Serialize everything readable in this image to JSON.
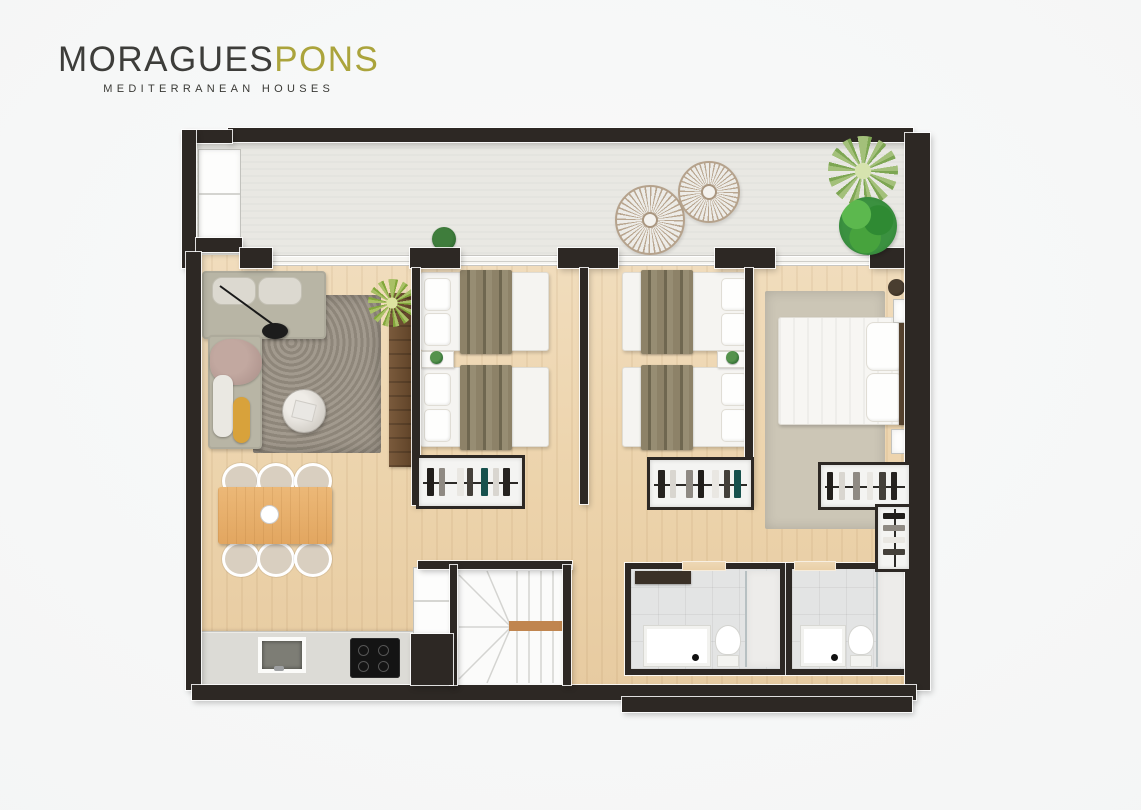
{
  "brand": {
    "wordmark_primary": "MORAGUES",
    "wordmark_accent": "PONS",
    "tagline": "MEDITERRANEAN HOUSES"
  },
  "palette": {
    "accent": "#aba43c",
    "wall": "#2d2824",
    "wood": "#ecd3ab",
    "terrace": "#e9e8e3",
    "tile": "#e3e4e4",
    "sofa": "#b8b5a5",
    "rug_living": "#9a9184",
    "rug_master": "#ccc6b6",
    "throw": "#8d8268",
    "table_wood": "#e9b26e",
    "plant_green": "#3f9b3f"
  },
  "floor_plan": {
    "type": "apartment-top-down-render",
    "rooms": [
      {
        "name": "terrace",
        "furniture": [
          "storage-closet",
          "sun-parasol",
          "sun-parasol",
          "potted-plant",
          "palm-plant",
          "green-bush"
        ]
      },
      {
        "name": "living-dining-kitchen",
        "furniture": [
          "corner-sofa",
          "floor-lamp",
          "area-rug",
          "round-coffee-table",
          "sideboard",
          "palm-plant",
          "dining-table",
          "six-chairs",
          "kitchen-counter",
          "sink",
          "cooktop",
          "appliance-column"
        ]
      },
      {
        "name": "bedroom-1",
        "furniture": [
          "twin-bed",
          "twin-bed",
          "nightstand",
          "open-wardrobe"
        ]
      },
      {
        "name": "bedroom-2",
        "furniture": [
          "twin-bed",
          "twin-bed",
          "nightstand",
          "open-wardrobe"
        ]
      },
      {
        "name": "master-bedroom",
        "furniture": [
          "double-bed",
          "area-rug",
          "nightstand",
          "nightstand",
          "open-wardrobe",
          "corner-wardrobe"
        ]
      },
      {
        "name": "bathroom-1",
        "furniture": [
          "vanity-sink",
          "toilet",
          "walk-in-shower",
          "wall-shelf"
        ]
      },
      {
        "name": "bathroom-2",
        "furniture": [
          "vanity-sink",
          "toilet",
          "walk-in-shower"
        ]
      },
      {
        "name": "staircase",
        "furniture": [
          "u-shaped-stairs",
          "closet"
        ]
      }
    ]
  }
}
